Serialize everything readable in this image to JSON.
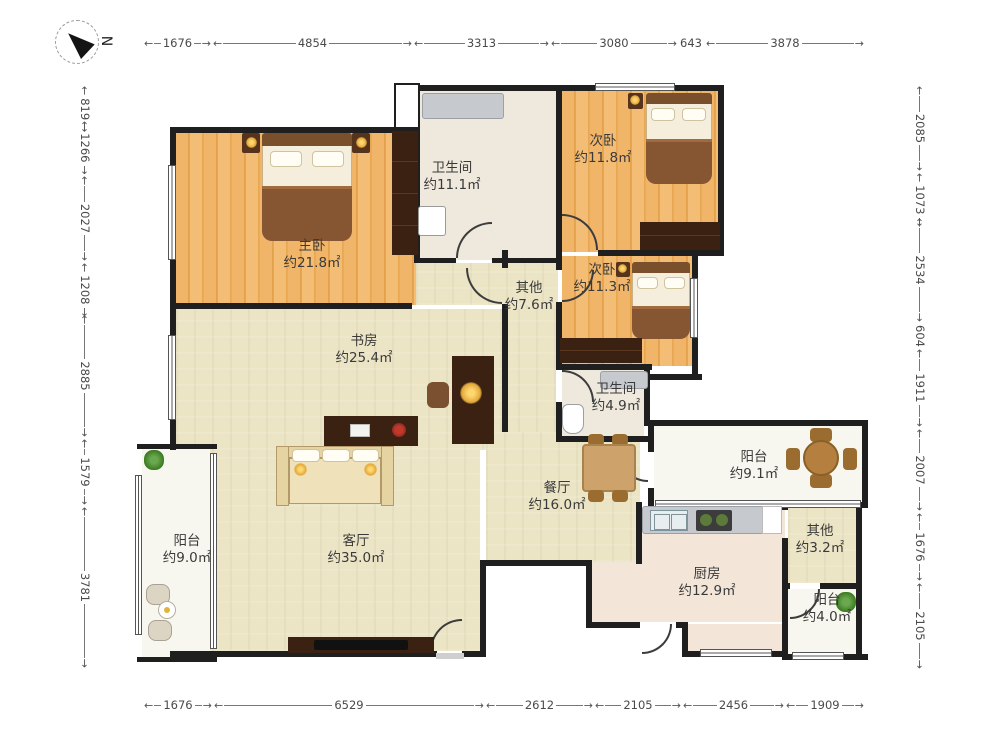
{
  "compass": {
    "label": "N"
  },
  "dimensions": {
    "top": [
      "1676",
      "4854",
      "3313",
      "3080",
      "643",
      "3878"
    ],
    "bottom": [
      "1676",
      "6529",
      "2612",
      "2105",
      "2456",
      "1909"
    ],
    "left": [
      "819",
      "1266",
      "2027",
      "1208",
      "2885",
      "1579",
      "3781"
    ],
    "right": [
      "2085",
      "1073",
      "2534",
      "604",
      "1911",
      "2007",
      "1676",
      "2105"
    ]
  },
  "rooms": [
    {
      "name": "主卧",
      "area": "约21.8㎡"
    },
    {
      "name": "卫生间",
      "area": "约11.1㎡"
    },
    {
      "name": "次卧",
      "area": "约11.8㎡"
    },
    {
      "name": "次卧",
      "area": "约11.3㎡"
    },
    {
      "name": "其他",
      "area": "约7.6㎡"
    },
    {
      "name": "书房",
      "area": "约25.4㎡"
    },
    {
      "name": "卫生间",
      "area": "约4.9㎡"
    },
    {
      "name": "阳台",
      "area": "约9.1㎡"
    },
    {
      "name": "餐厅",
      "area": "约16.0㎡"
    },
    {
      "name": "其他",
      "area": "约3.2㎡"
    },
    {
      "name": "客厅",
      "area": "约35.0㎡"
    },
    {
      "name": "阳台",
      "area": "约9.0㎡"
    },
    {
      "name": "厨房",
      "area": "约12.9㎡"
    },
    {
      "name": "阳台",
      "area": "约4.0㎡"
    }
  ],
  "colors": {
    "wall": "#1f1f1f",
    "wood_floor": "#eeae5f",
    "tile_floor": "#ebe4c5",
    "bath_floor": "#eee9dc",
    "kitchen_floor": "#f3e6d9",
    "balcony_floor": "#f8f7ef",
    "dimension_text": "#4a4a4a",
    "label_text": "#3a3a3a"
  }
}
